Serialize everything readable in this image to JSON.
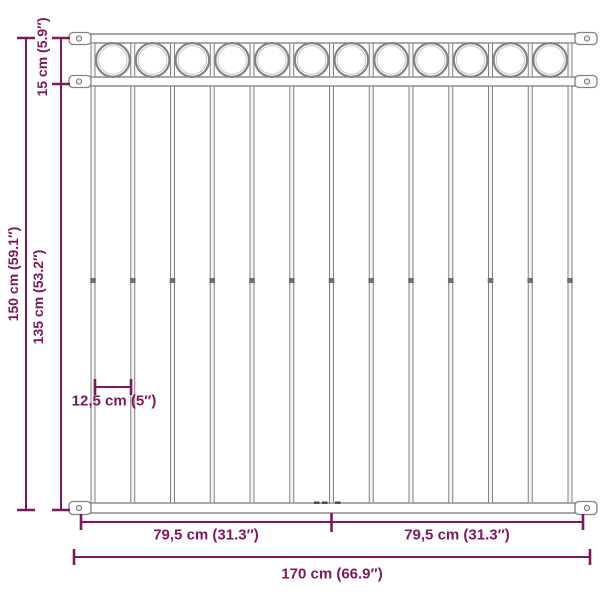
{
  "diagram": {
    "background_color": "#ffffff",
    "accent_color": "#7E175B",
    "fence_color": "#828282",
    "fence_light_color": "#c6c6c6",
    "fence": {
      "ring_count": 12,
      "bar_count": 13,
      "rail_count": 3,
      "bracket_count": 6
    },
    "dimensions": {
      "total_height": {
        "label": "150 cm (59.1″)"
      },
      "lower_height": {
        "label": "135 cm (53.2″)"
      },
      "top_section_height": {
        "label": "15 cm (5.9″)"
      },
      "bar_spacing": {
        "label": "12,5 cm (5″)"
      },
      "half_width_left": {
        "label": "79,5 cm (31.3″)"
      },
      "half_width_right": {
        "label": "79,5 cm (31.3″)"
      },
      "total_width": {
        "label": "170 cm (66.9″)"
      }
    }
  }
}
